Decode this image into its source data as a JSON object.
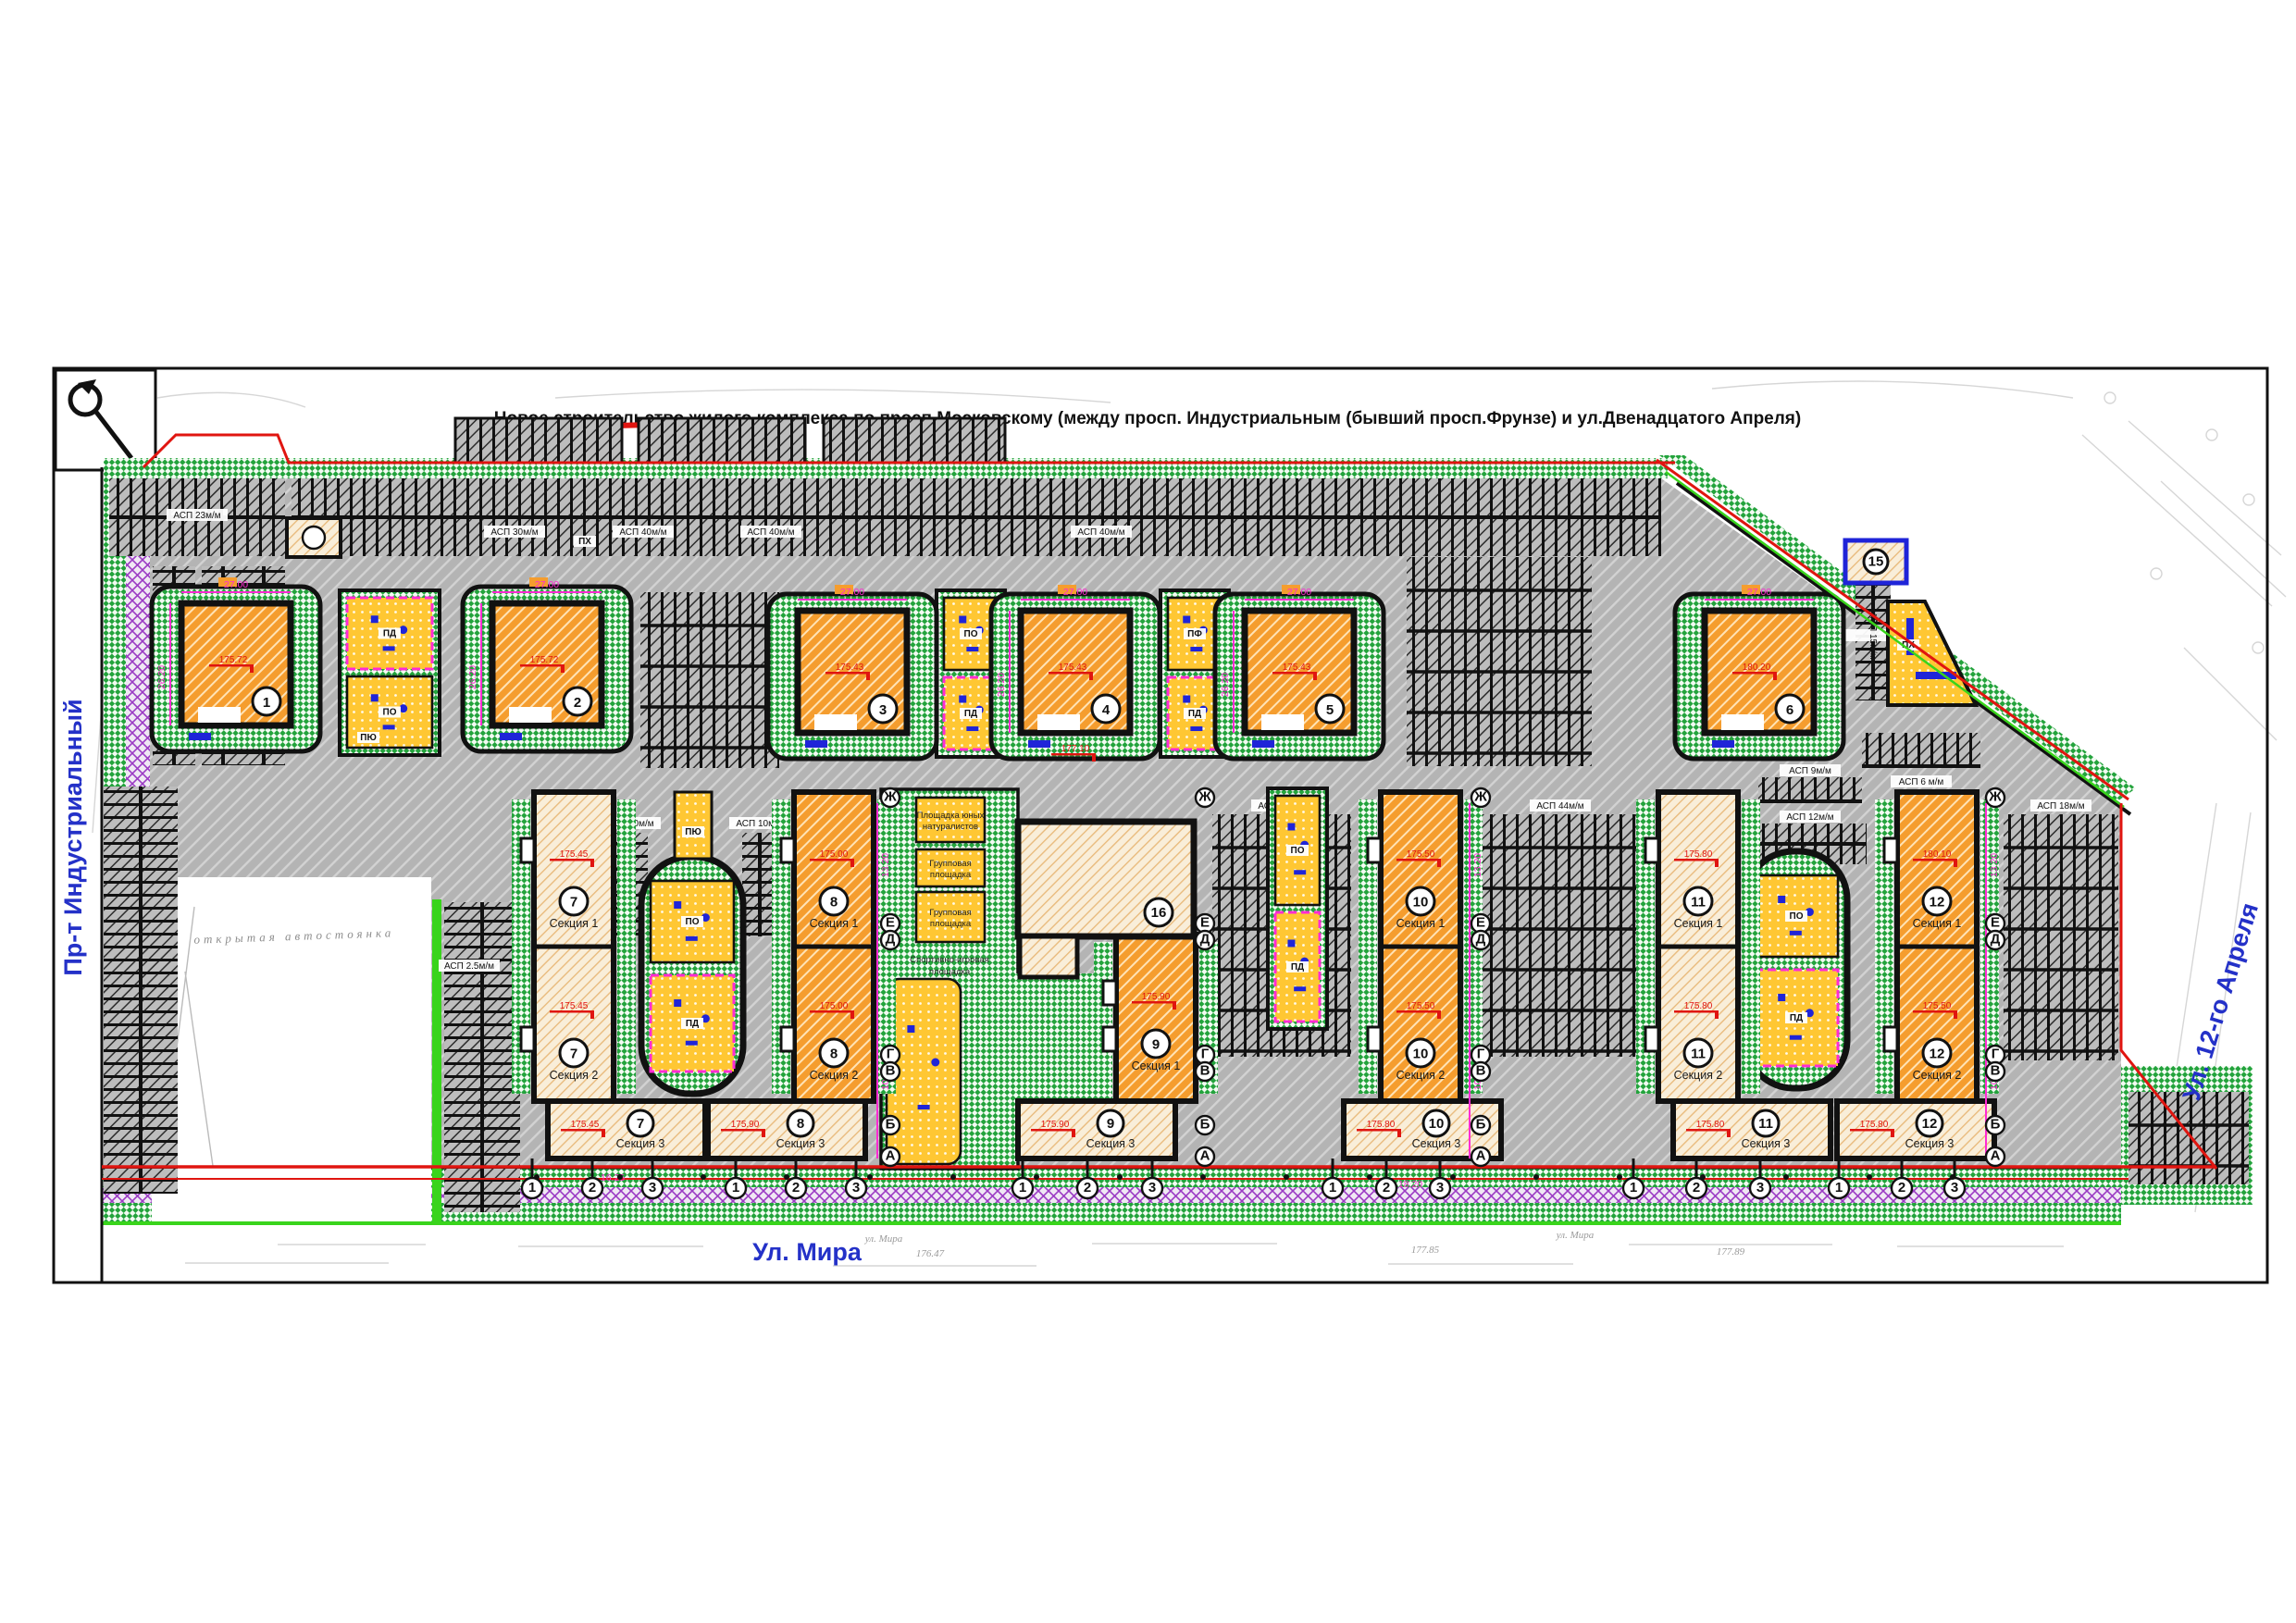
{
  "title": "Новое строительство жилого комплекса по просп.Московскому (между просп. Индустриальным (бывший просп.Фрунзе)   и ул.Двенадцатого Апреля)",
  "streets": {
    "left": "Пр-т Индустриальный",
    "bottom": "Ул. Мира",
    "right": "Ул. 12-го Апреля"
  },
  "buildings": {
    "towers": [
      {
        "num": "1",
        "elevation": "175.72"
      },
      {
        "num": "2",
        "elevation": "175.72"
      },
      {
        "num": "3",
        "elevation": "175.43"
      },
      {
        "num": "4",
        "elevation": "175.43"
      },
      {
        "num": "5",
        "elevation": "175.43"
      },
      {
        "num": "6",
        "elevation": "180.20"
      }
    ],
    "slabs": [
      {
        "num": "7",
        "sections": [
          "Секция 1",
          "Секция 2",
          "Секция 3"
        ],
        "elevations": [
          "175.45",
          "175.45",
          "175.45"
        ]
      },
      {
        "num": "8",
        "sections": [
          "Секция 1",
          "Секция 2",
          "Секция 3"
        ],
        "elevations": [
          "175.00",
          "175.00",
          "175.90"
        ]
      },
      {
        "num": "9",
        "sections": [
          "Секция 1",
          "Секция 2",
          "Секция 3"
        ],
        "elevations": [
          "175.90",
          "175.90",
          "175.90"
        ]
      },
      {
        "num": "10",
        "sections": [
          "Секция 1",
          "Секция 2",
          "Секция 3"
        ],
        "elevations": [
          "175.50",
          "175.50",
          "175.80"
        ]
      },
      {
        "num": "11",
        "sections": [
          "Секция 1",
          "Секция 2",
          "Секция 3"
        ],
        "elevations": [
          "175.80",
          "175.80",
          "175.80"
        ]
      },
      {
        "num": "12",
        "sections": [
          "Секция 1",
          "Секция 2",
          "Секция 3"
        ],
        "elevations": [
          "180.10",
          "175.50",
          "175.80"
        ]
      }
    ],
    "kindergarten": {
      "num": "16"
    },
    "service": {
      "num": "15"
    }
  },
  "playgrounds": {
    "codes": {
      "po": "ПО",
      "pd": "ПД",
      "pf": "ПФ",
      "px": "ПХ",
      "pyu": "ПЮ"
    },
    "kg": [
      [
        "Площадка юных",
        "натуралистов"
      ],
      [
        "Групповая",
        "площадка"
      ],
      [
        "Групповая",
        "площадка"
      ],
      [
        "Спортивно-игровая",
        "площадка"
      ]
    ]
  },
  "parking": {
    "labels": [
      "АСП 23м/м",
      "АСП 30м/м",
      "АСП 40м/м",
      "АСП 40м/м",
      "АСП 40м/м",
      "АСП 10м/м",
      "АСП 10м/м",
      "АСП 44м/м",
      "АСП 44м/м",
      "АСП 2.5м/м",
      "АСП 9м/м",
      "АСП 12м/м",
      "АСП 6 м/м",
      "АСП 18м/м",
      "АСП 15м/м"
    ],
    "open_lot": "открытая автостоянка"
  },
  "dimensions": {
    "top": "27.00",
    "side": "26.20",
    "w1": "13.20",
    "w2": "10.40",
    "b1": "16.25",
    "b2": "18.20"
  },
  "elevations_extra": [
    "177.10"
  ],
  "axes": {
    "letters": [
      "Ж",
      "Е",
      "Д",
      "Г",
      "В",
      "Б",
      "А"
    ],
    "numbers": [
      "1",
      "2",
      "3"
    ]
  },
  "survey": {
    "street": "ул. Мира",
    "marks": [
      "176.47",
      "177.85",
      "177.89"
    ]
  },
  "colors": {
    "paving": "#b7b7b7",
    "green": "#23a33c",
    "orange": "#f59d2e",
    "beige": "#f8ecd8",
    "yellow": "#ffc733",
    "purple": "#9b3bc4",
    "blue": "#1f24d8",
    "red": "#e01510",
    "magenta": "#ff2bd4",
    "street_text": "#2431c8",
    "lime": "#39d41c"
  }
}
